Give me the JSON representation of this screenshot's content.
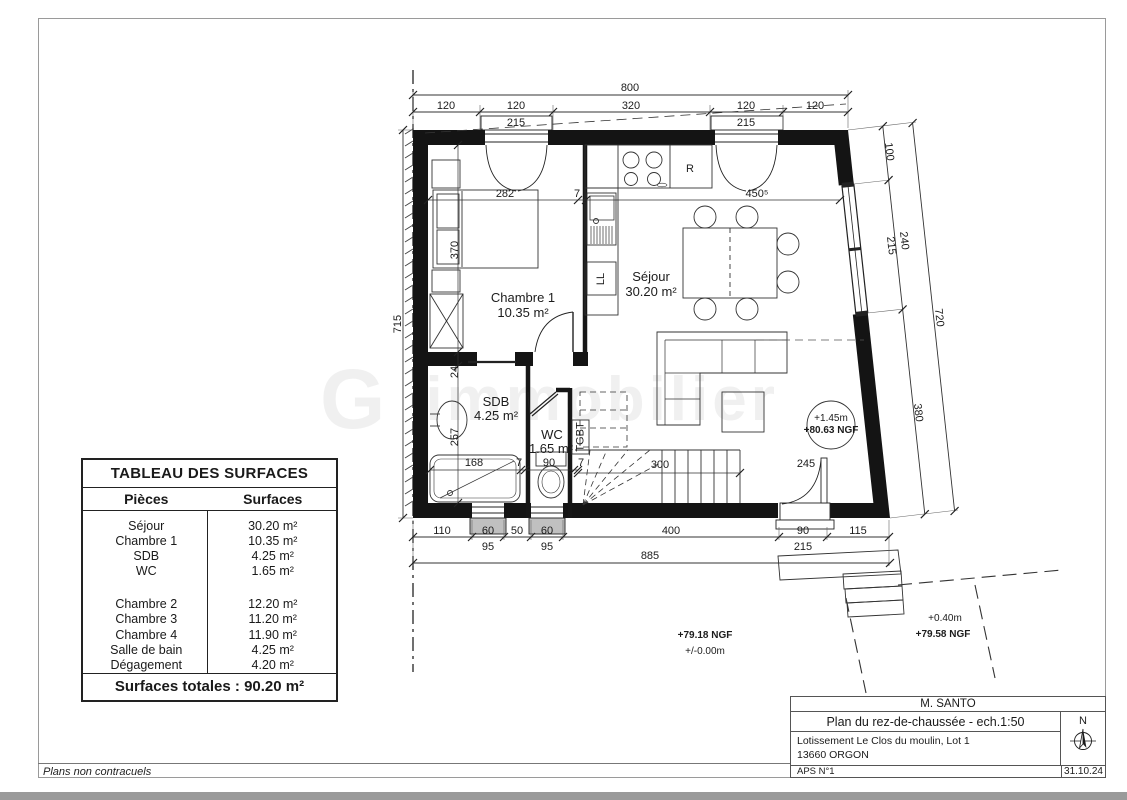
{
  "watermark": {
    "logo": "G",
    "text": "immobilier"
  },
  "colors": {
    "ink": "#1c1c1c",
    "wall": "#141414",
    "sill_gray": "#c0c0c0",
    "border_gray": "#9a9a9a"
  },
  "surface_table": {
    "title": "TABLEAU DES SURFACES",
    "col_pieces": "Pièces",
    "col_surfaces": "Surfaces",
    "rows1": [
      {
        "piece": "Séjour",
        "surface": "30.20 m²"
      },
      {
        "piece": "Chambre 1",
        "surface": "10.35 m²"
      },
      {
        "piece": "SDB",
        "surface": "4.25 m²"
      },
      {
        "piece": "WC",
        "surface": "1.65 m²"
      }
    ],
    "rows2": [
      {
        "piece": "Chambre 2",
        "surface": "12.20 m²"
      },
      {
        "piece": "Chambre 3",
        "surface": "11.20 m²"
      },
      {
        "piece": "Chambre 4",
        "surface": "11.90 m²"
      },
      {
        "piece": "Salle de bain",
        "surface": "4.25 m²"
      },
      {
        "piece": "Dégagement",
        "surface": "4.20 m²"
      }
    ],
    "total": "Surfaces totales : 90.20 m²"
  },
  "title_block": {
    "client": "M. SANTO",
    "drawing_title": "Plan du rez-de-chaussée - ech.1:50",
    "address_line1": "Lotissement Le Clos du moulin, Lot 1",
    "address_line2": "13660 ORGON",
    "phase": "APS N°1",
    "date": "31.10.24",
    "north_label": "N"
  },
  "footer": {
    "note": "Plans non contracuels"
  },
  "plan": {
    "rooms": {
      "sejour": {
        "name": "Séjour",
        "area": "30.20 m²"
      },
      "chambre1": {
        "name": "Chambre 1",
        "area": "10.35 m²"
      },
      "sdb": {
        "name": "SDB",
        "area": "4.25 m²"
      },
      "wc": {
        "name": "WC",
        "area": "1.65 m²"
      }
    },
    "equipment": {
      "fridge": "R",
      "washing_machine": "LL",
      "electrical_panel": "TGBT"
    },
    "levels": {
      "upper": {
        "rel": "+1.45m",
        "ngf": "+80.63 NGF"
      },
      "ground": {
        "ngf": "+79.18 NGF",
        "rel": "+/-0.00m"
      },
      "terrace": {
        "rel": "+0.40m",
        "ngf": "+79.58 NGF"
      }
    },
    "dims": {
      "top_total": "800",
      "top_1": "120",
      "top_2": "120",
      "top_2b": "215",
      "top_3": "320",
      "top_4": "120",
      "top_4b": "215",
      "top_5": "120",
      "left_total": "715",
      "right_1": "100",
      "right_2": "240",
      "right_2b": "215",
      "right_3": "380",
      "right_total": "720",
      "bottom_1": "110",
      "bottom_2": "60",
      "bottom_2b": "95",
      "bottom_3": "50",
      "bottom_4": "60",
      "bottom_4b": "95",
      "bottom_5": "400",
      "bottom_6": "90",
      "bottom_6b": "215",
      "bottom_7": "115",
      "bottom_total": "885",
      "int_chambre_w": "282",
      "int_wall_a": "7",
      "int_kitchen_w": "450⁵",
      "int_chambre_h": "370",
      "int_wall_b": "24",
      "int_sdb_h": "257",
      "int_bath_w": "168",
      "int_wall_c": "7",
      "int_wc_w": "90",
      "int_wall_d": "7",
      "int_stair_w": "300",
      "int_door": "245"
    }
  }
}
